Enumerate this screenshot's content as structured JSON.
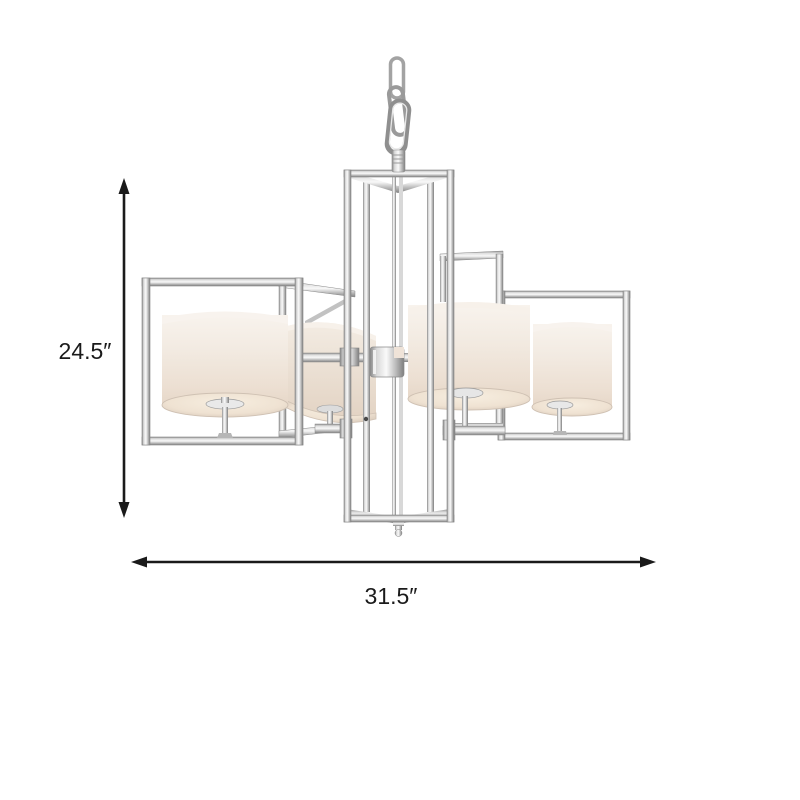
{
  "page": {
    "background_color": "#ffffff"
  },
  "product_image": {
    "subject": "chrome-square-frame-chandelier-four-drum-shades",
    "colors": {
      "chrome_highlight": "#f9f9f9",
      "chrome_mid": "#c7c7c7",
      "chrome_dark": "#7e7e7e",
      "shade_cream": "#f2e9e0",
      "shade_rim": "#d8c9ba",
      "annotation": "#1a1a1a"
    }
  },
  "annotations": {
    "height": {
      "label": "24.5″"
    },
    "width": {
      "label": "31.5″"
    }
  }
}
